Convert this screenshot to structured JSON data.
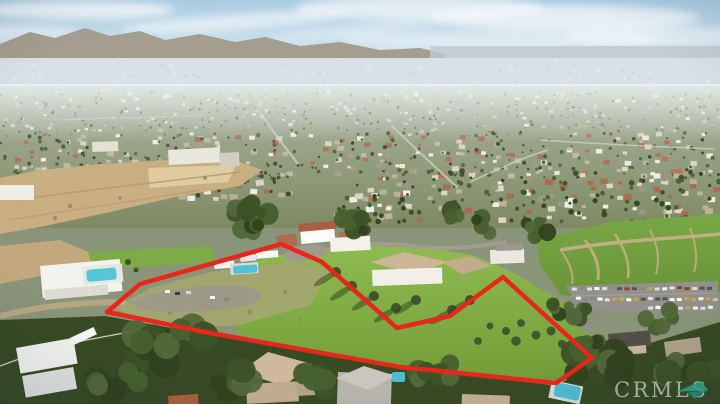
{
  "scene": {
    "type": "aerial-photograph",
    "description": "Daytime aerial drone photo of a hillside suburban neighborhood; a large vacant green parcel in the foreground is outlined in red, with houses, pools, a dirt lot, a parking lot full of cars, and a hazy valley with distant mountains behind."
  },
  "property_outline": {
    "color": "#e8271b",
    "stroke_width": 4.5,
    "points": [
      [
        281,
        244
      ],
      [
        322,
        262
      ],
      [
        397,
        328
      ],
      [
        450,
        316
      ],
      [
        503,
        277
      ],
      [
        592,
        358
      ],
      [
        556,
        383
      ],
      [
        400,
        367
      ],
      [
        205,
        332
      ],
      [
        107,
        312
      ],
      [
        140,
        284
      ]
    ]
  },
  "watermark": {
    "text": "CRMLS",
    "text_color": "rgba(255,255,255,0.55)",
    "logo_color": "#2ba08f",
    "logo_dark_color": "#1d8678"
  }
}
